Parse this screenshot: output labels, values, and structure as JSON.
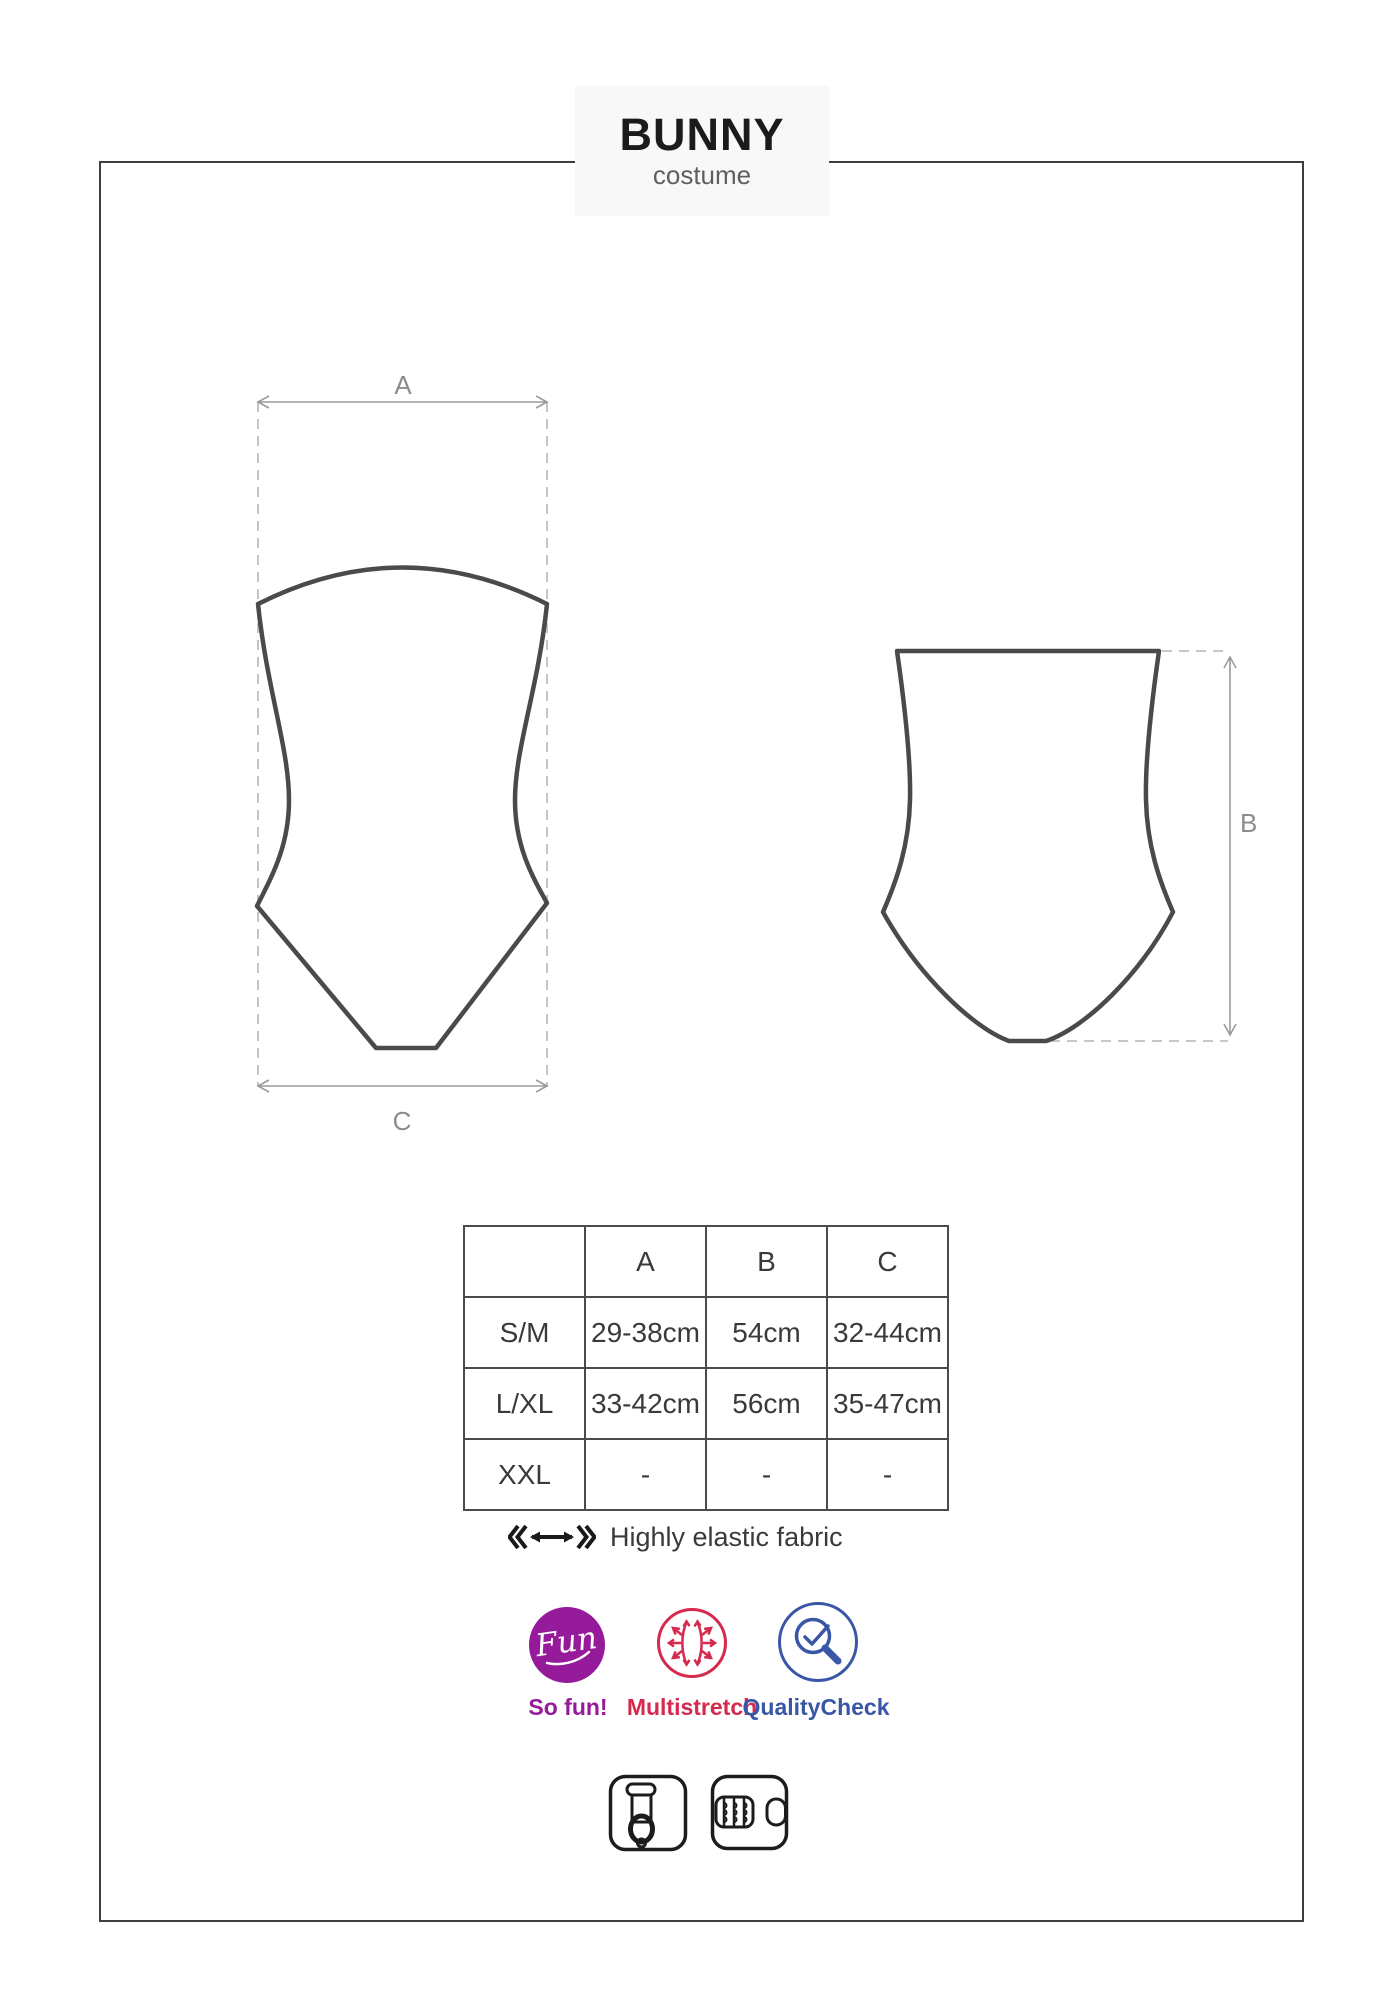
{
  "page": {
    "title": "BUNNY",
    "subtitle": "costume"
  },
  "diagram": {
    "front_view": {
      "width_label": "A",
      "bottom_width_label": "C"
    },
    "back_view": {
      "height_label": "B"
    }
  },
  "size_table": {
    "columns": [
      "A",
      "B",
      "C"
    ],
    "rows": [
      {
        "size": "S/M",
        "A": "29-38cm",
        "B": "54cm",
        "C": "32-44cm"
      },
      {
        "size": "L/XL",
        "A": "33-42cm",
        "B": "56cm",
        "C": "35-47cm"
      },
      {
        "size": "XXL",
        "A": "-",
        "B": "-",
        "C": "-"
      }
    ]
  },
  "fabric_note": {
    "label": "Highly elastic fabric",
    "icon": "elastic-stretch-arrow-icon"
  },
  "badges": [
    {
      "id": "fun",
      "icon": "fun-badge-icon",
      "icon_text": "Fun",
      "label": "So fun!",
      "color": "#951B9B"
    },
    {
      "id": "multistretch",
      "icon": "multistretch-icon",
      "label": "Multistretch",
      "color": "#D5294E"
    },
    {
      "id": "quality_check",
      "icon": "quality-check-icon",
      "label": "QualityCheck",
      "color": "#3A56A6"
    }
  ],
  "care_icons": [
    {
      "icon": "garter-clip-icon"
    },
    {
      "icon": "hook-eye-closure-icon"
    }
  ],
  "colors": {
    "garment_outline": "#4A4A4C",
    "dimension_lines": "#9B9B9B",
    "table_border": "#4A4A4A",
    "text": "#3A3A3A",
    "fun_purple": "#951B9B",
    "stretch_red": "#D5294E",
    "quality_blue": "#3A56A6"
  }
}
